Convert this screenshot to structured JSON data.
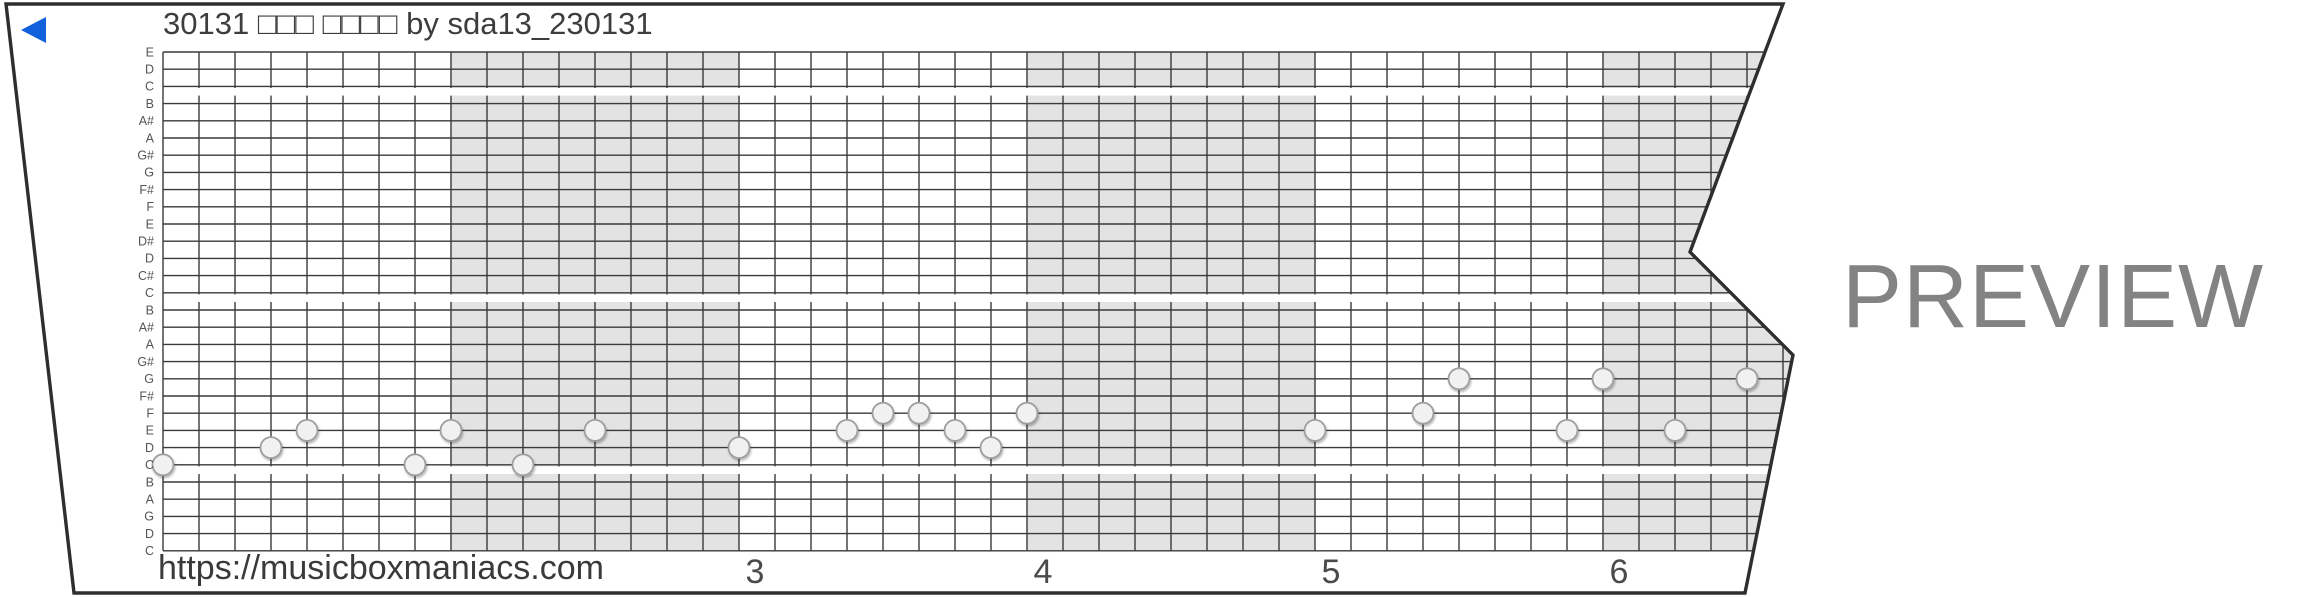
{
  "header": {
    "title": "30131 □□□ □□□□ by sda13_230131",
    "play_icon_color": "#1161dc"
  },
  "watermark": {
    "text": "PREVIEW",
    "color": "#838383"
  },
  "footer": {
    "url": "https://musicboxmaniacs.com",
    "measure_numbers": [
      {
        "label": "3",
        "measure_index": 2
      },
      {
        "label": "4",
        "measure_index": 3
      },
      {
        "label": "5",
        "measure_index": 4
      },
      {
        "label": "6",
        "measure_index": 5
      }
    ]
  },
  "colors": {
    "paper_fill": "#ffffff",
    "paper_edge": "#2e2e2e",
    "grid_line": "#3a3a3a",
    "measure_shade": "#e3e3e3",
    "note_fill": "#f1f1f1",
    "note_stroke": "#9e9e9e",
    "label_text": "#555555",
    "number_text": "#4a4a4a"
  },
  "chart_data": {
    "type": "scatter",
    "title": "30131 □□□ □□□□ by sda13_230131",
    "description": "30-note music box paper strip (piano roll); holes sit on pitch lines, 8 columns per measure, alternating measures shaded, white octave break under each C line",
    "y_line_labels_top_to_bottom": [
      "E",
      "D",
      "C",
      "B",
      "A#",
      "A",
      "G#",
      "G",
      "F#",
      "F",
      "E",
      "D#",
      "D",
      "C#",
      "C",
      "B",
      "A#",
      "A",
      "G#",
      "G",
      "F#",
      "F",
      "E",
      "D",
      "C",
      "B",
      "A",
      "G",
      "D",
      "C"
    ],
    "octave_break_after_lines": [
      3,
      15,
      25
    ],
    "columns_per_measure": 8,
    "shaded_measures_from_strip_start": [
      1,
      3,
      5
    ],
    "visible_measure_numbers": [
      "3",
      "4",
      "5",
      "6"
    ],
    "notes": [
      {
        "col": 0,
        "line": 25,
        "pitch": "C5"
      },
      {
        "col": 3,
        "line": 24,
        "pitch": "D5"
      },
      {
        "col": 4,
        "line": 23,
        "pitch": "E5"
      },
      {
        "col": 7,
        "line": 25,
        "pitch": "C5"
      },
      {
        "col": 8,
        "line": 23,
        "pitch": "E5"
      },
      {
        "col": 10,
        "line": 25,
        "pitch": "C5"
      },
      {
        "col": 12,
        "line": 23,
        "pitch": "E5"
      },
      {
        "col": 16,
        "line": 24,
        "pitch": "D5"
      },
      {
        "col": 19,
        "line": 23,
        "pitch": "E5"
      },
      {
        "col": 20,
        "line": 22,
        "pitch": "F5"
      },
      {
        "col": 21,
        "line": 22,
        "pitch": "F5"
      },
      {
        "col": 22,
        "line": 23,
        "pitch": "E5"
      },
      {
        "col": 23,
        "line": 24,
        "pitch": "D5"
      },
      {
        "col": 24,
        "line": 22,
        "pitch": "F5"
      },
      {
        "col": 32,
        "line": 23,
        "pitch": "E5"
      },
      {
        "col": 35,
        "line": 22,
        "pitch": "F5"
      },
      {
        "col": 36,
        "line": 20,
        "pitch": "G5"
      },
      {
        "col": 39,
        "line": 23,
        "pitch": "E5"
      },
      {
        "col": 40,
        "line": 20,
        "pitch": "G5"
      },
      {
        "col": 42,
        "line": 23,
        "pitch": "E5"
      },
      {
        "col": 44,
        "line": 20,
        "pitch": "G5"
      }
    ]
  }
}
